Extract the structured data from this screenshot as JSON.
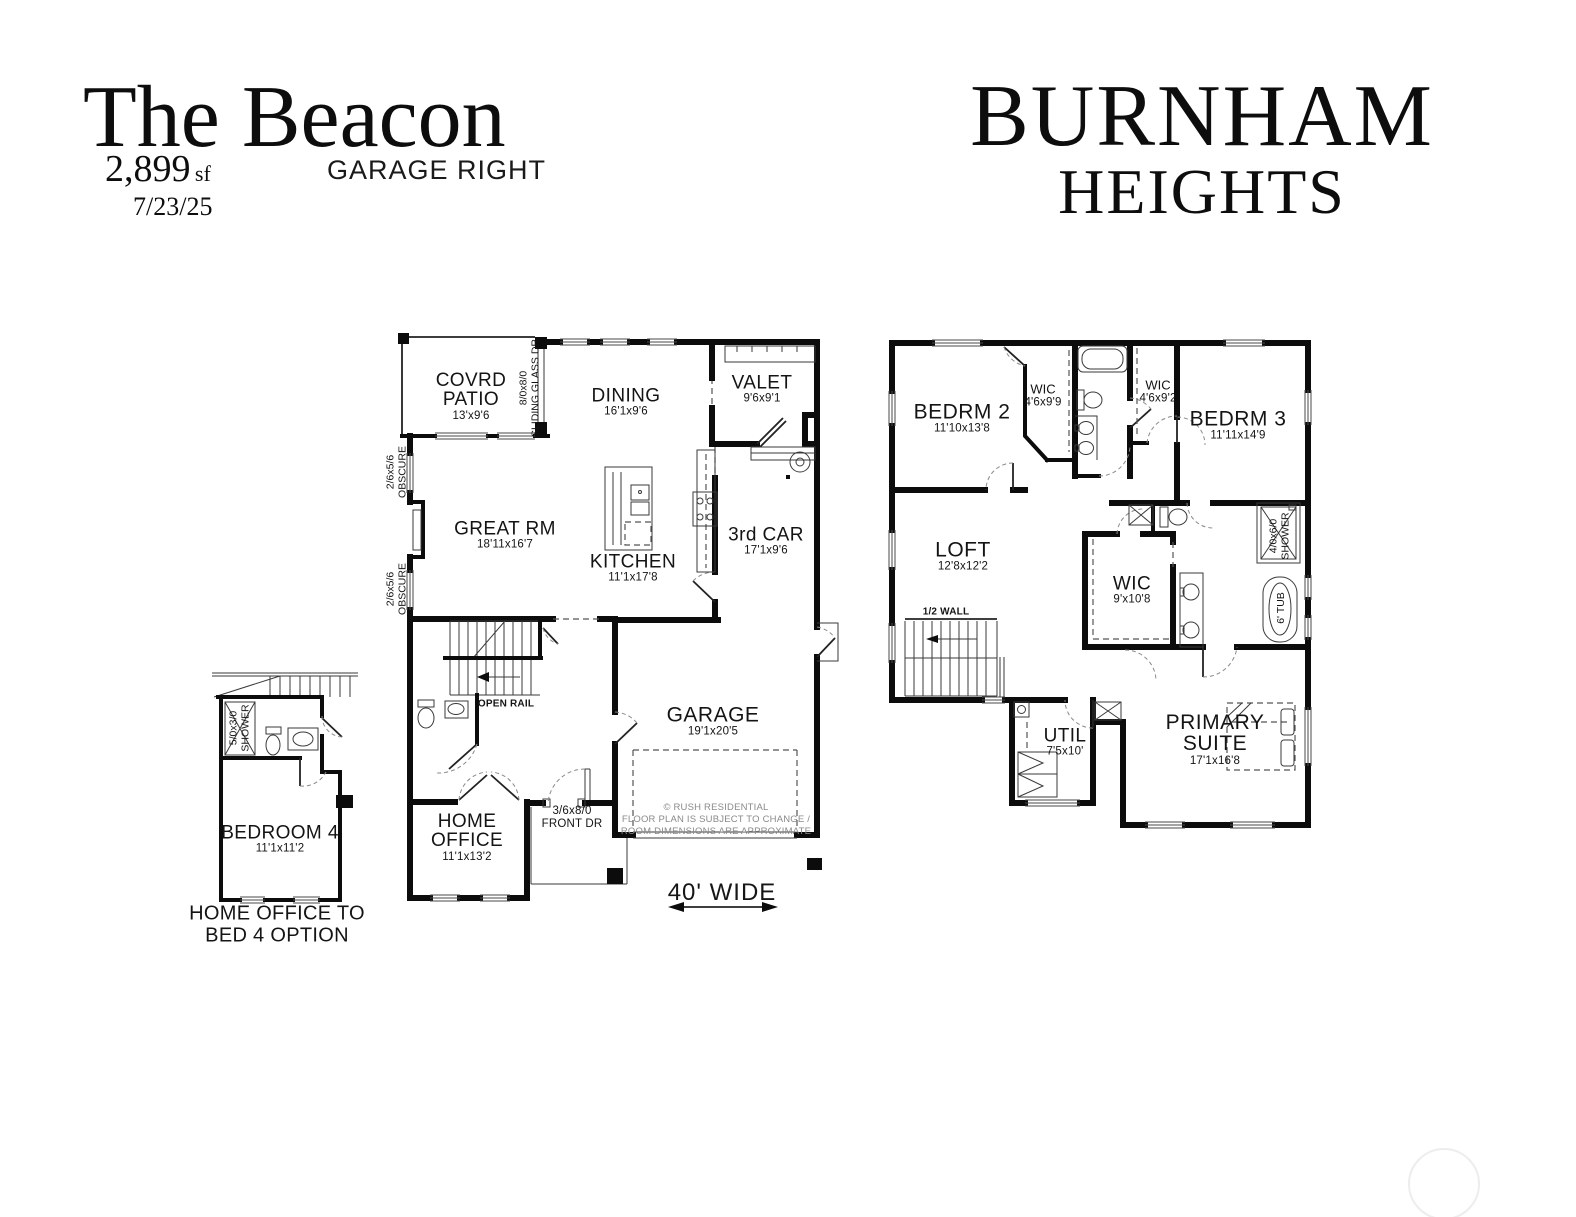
{
  "colors": {
    "ink": "#0c0c0c",
    "muted": "#8a8a8a"
  },
  "header": {
    "plan_name": "The Beacon",
    "area_value": "2,899",
    "area_unit": "sf",
    "date": "7/23/25",
    "variant": "GARAGE RIGHT",
    "community_line1": "BURNHAM",
    "community_line2": "HEIGHTS"
  },
  "first_floor": {
    "covrd_patio": {
      "name_l1": "COVRD",
      "name_l2": "PATIO",
      "dims": "13'x9'6"
    },
    "sliding_door": {
      "l1": "8/0x8/0",
      "l2": "SLIDING GLASS DR"
    },
    "dining": {
      "name": "DINING",
      "dims": "16'1x9'6"
    },
    "valet": {
      "name": "VALET",
      "dims": "9'6x9'1"
    },
    "obscure_window": {
      "l1": "2/6x5/6",
      "l2": "OBSCURE"
    },
    "great_rm": {
      "name": "GREAT RM",
      "dims": "18'11x16'7"
    },
    "kitchen": {
      "name": "KITCHEN",
      "dims": "11'1x17'8"
    },
    "third_car": {
      "name": "3rd CAR",
      "dims": "17'1x9'6"
    },
    "open_rail": "OPEN RAIL",
    "garage": {
      "name": "GARAGE",
      "dims": "19'1x20'5"
    },
    "home_office": {
      "name_l1": "HOME",
      "name_l2": "OFFICE",
      "dims": "11'1x13'2"
    },
    "front_door": {
      "l1": "3/6x8/0",
      "l2": "FRONT DR"
    },
    "disclaimer": {
      "l1": "© RUSH RESIDENTIAL",
      "l2": "FLOOR PLAN IS SUBJECT TO CHANGE /",
      "l3": "ROOM DIMENSIONS ARE APPROXIMATE"
    },
    "width_note": "40' WIDE"
  },
  "option_plan": {
    "shower": {
      "l1": "5/0x3/0",
      "l2": "SHOWER"
    },
    "bedroom4": {
      "name": "BEDROOM 4",
      "dims": "11'1x11'2"
    },
    "caption_l1": "HOME OFFICE TO",
    "caption_l2": "BED 4 OPTION"
  },
  "second_floor": {
    "bedrm2": {
      "name": "BEDRM 2",
      "dims": "11'10x13'8"
    },
    "wic_bedrm2": {
      "name": "WIC",
      "dims": "4'6x9'9"
    },
    "wic_bedrm3": {
      "name": "WIC",
      "dims": "4'6x9'2"
    },
    "bedrm3": {
      "name": "BEDRM 3",
      "dims": "11'11x14'9"
    },
    "loft": {
      "name": "LOFT",
      "dims": "12'8x12'2"
    },
    "half_wall": "1/2 WALL",
    "wic_primary": {
      "name": "WIC",
      "dims": "9'x10'8"
    },
    "shower": {
      "l1": "4/0x6/0",
      "l2": "SHOWER"
    },
    "tub": "6' TUB",
    "util": {
      "name": "UTIL",
      "dims": "7'5x10'"
    },
    "primary_suite": {
      "name_l1": "PRIMARY",
      "name_l2": "SUITE",
      "dims": "17'1x16'8"
    }
  }
}
